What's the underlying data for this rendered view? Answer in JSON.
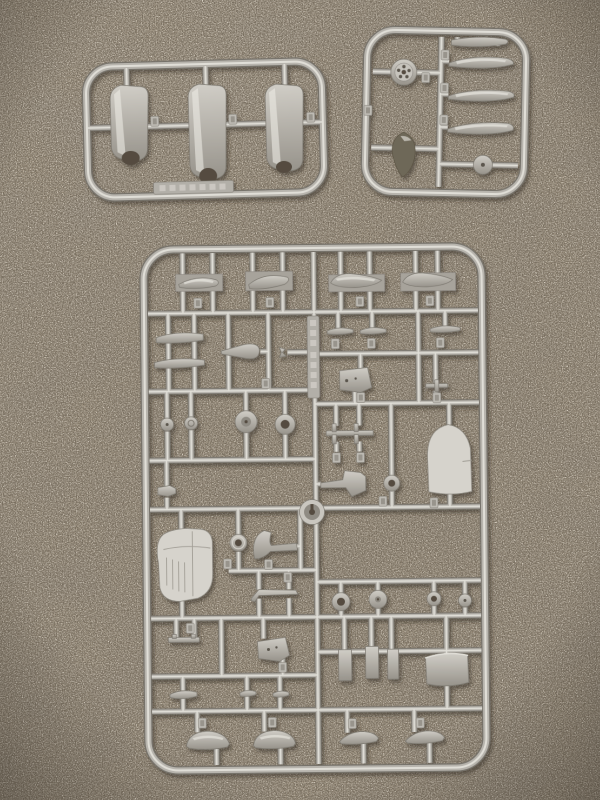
{
  "scene": {
    "type": "photograph",
    "description": "Top-down photo of three silver-grey injection-moulded model aircraft sprues (part runners) lying on a beige speckled carpet",
    "surface": "carpet",
    "visible_text": "embossed runner lettering present but illegible"
  },
  "colors": {
    "carpet_base": "#8c8275",
    "carpet_speckle_light": "#c3baab",
    "carpet_speckle_dark": "#4a4237",
    "runner_dark": "#76726a",
    "runner_mid": "#b7b4ad",
    "runner_highlight": "#e0ded7",
    "part_mid": "#b0ada5",
    "part_light": "#d6d3cc",
    "spinner_dark": "#6e6759"
  },
  "sprues": [
    {
      "id": "sprue-top-left",
      "frame": "rounded rectangle",
      "part_count": 3,
      "parts": [
        "cowling-half",
        "cowling-half",
        "cowling-half"
      ],
      "label_plate": "embossed text (illegible)"
    },
    {
      "id": "sprue-top-right",
      "frame": "rounded square",
      "part_count": 7,
      "parts": [
        "propeller-hub",
        "spinner",
        "propeller-blade",
        "propeller-blade",
        "propeller-blade",
        "propeller-blade",
        "wheel-disc"
      ]
    },
    {
      "id": "sprue-large",
      "frame": "rounded rectangle",
      "part_count": 40,
      "parts": [
        "tank-half x4",
        "tailplane-half x5",
        "exhaust-cone",
        "bulkhead-plate x2",
        "wheel-or-ring x12",
        "bomb-rack",
        "tail-fin",
        "landing-gear-bracket x3",
        "engine-cowling",
        "hub-key-part",
        "gun-bar",
        "seat-plate",
        "radiator-block x3",
        "cowl-panel",
        "small-airfoil x3",
        "canopy-float-half x4"
      ],
      "label_plate": "embossed vertical text (illegible)"
    }
  ]
}
